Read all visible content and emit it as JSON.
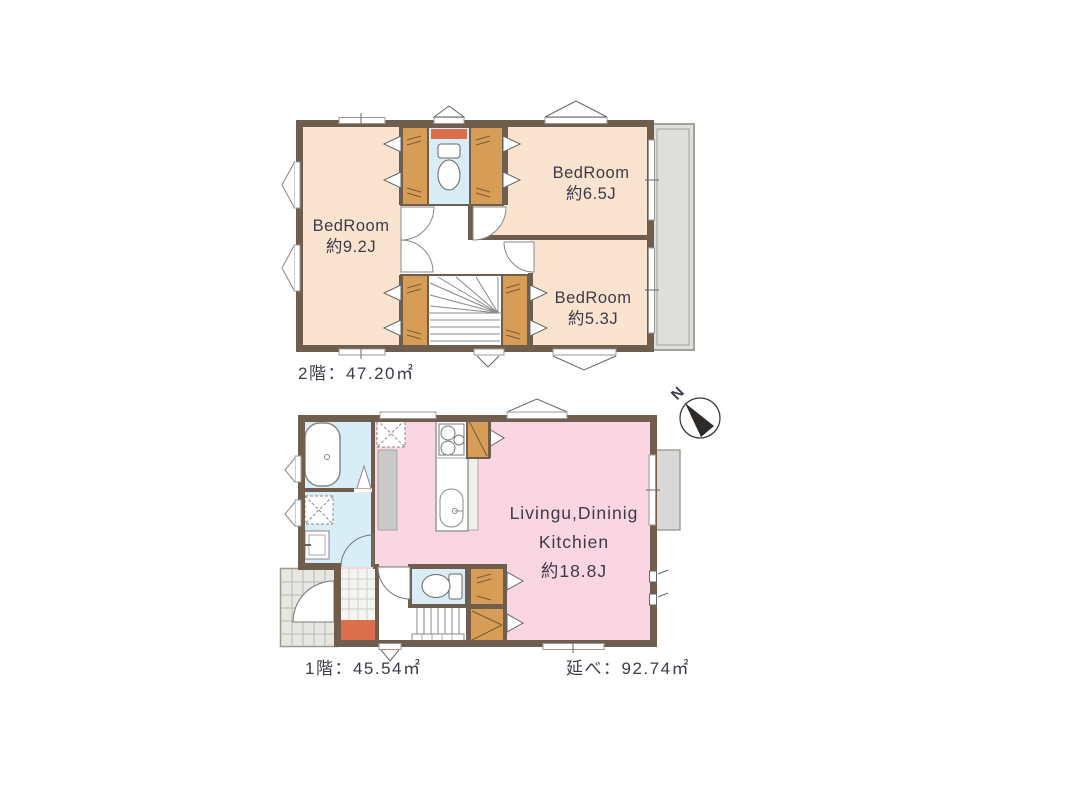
{
  "second_floor": {
    "area_label": "2階：47.20㎡",
    "bedroom_left": {
      "name": "BedRoom",
      "size": "約9.2J"
    },
    "bedroom_top_right": {
      "name": "BedRoom",
      "size": "約6.5J"
    },
    "bedroom_bottom_right": {
      "name": "BedRoom",
      "size": "約5.3J"
    }
  },
  "first_floor": {
    "area_label": "1階：45.54㎡",
    "ldk": {
      "line1": "Livingu,Dininig",
      "line2": "Kitchien",
      "size": "約18.8J"
    }
  },
  "summary": {
    "total_area_label": "延べ：92.74㎡"
  },
  "compass": {
    "north_label": "N"
  },
  "colors": {
    "wall": "#6F5E4E",
    "bedroom_fill": "#FAE3CF",
    "ldk_fill": "#F9D6E2",
    "wet_area_fill": "#D9EDF6",
    "closet_fill": "#D79D57",
    "accent_orange": "#DB6E4B",
    "balcony_fill": "#DEDEDC",
    "fixture_gray": "#C9C9C7",
    "text": "#3F3A47"
  }
}
